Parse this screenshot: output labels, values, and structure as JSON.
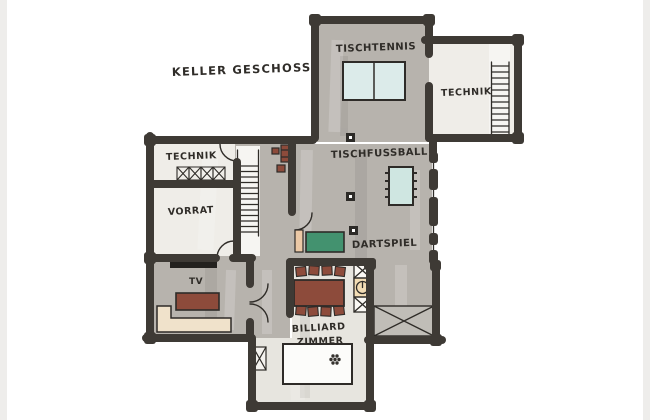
{
  "title": "KELLER GESCHOSS",
  "labels": {
    "tischtennis": "TISCHTENNIS",
    "technik_upper": "TECHNIK",
    "tischfussball": "TISCHFUSSBALL",
    "technik_left": "TECHNIK",
    "vorrat": "VORRAT",
    "dartspiel": "DARTSPIEL",
    "tv": "TV",
    "billiard_line1": "BILLIARD",
    "billiard_line2": "ZIMMER"
  },
  "furniture": [
    "table-tennis-table",
    "foosball-table",
    "dart-sideboard",
    "dining-table",
    "dining-chairs",
    "spiral-stair-shaft",
    "tv-screen",
    "sofa",
    "corner-sofa",
    "billiard-table",
    "staircase",
    "ladder",
    "ventilation-grid",
    "columns",
    "window-band",
    "crawl-space"
  ],
  "colors": {
    "wall": "#3e3a35",
    "ink": "#2f2c28",
    "floor_gray": "#b7b3ad",
    "floor_light": "#efede8",
    "floor_billiard": "#e7e5df",
    "stair_fill": "#f6f5f2",
    "table_tennis_blue": "#dcebea",
    "foosball_blue": "#cfe6e1",
    "sideboard_green": "#43926f",
    "furniture_red_brown": "#8d4b3b",
    "sofa_beige": "#f0e2cb",
    "shaft_tan": "#f3ddb5",
    "peach": "#ecc9a6",
    "tv_black": "#23211e",
    "paper_edge": "#eeedeb"
  }
}
